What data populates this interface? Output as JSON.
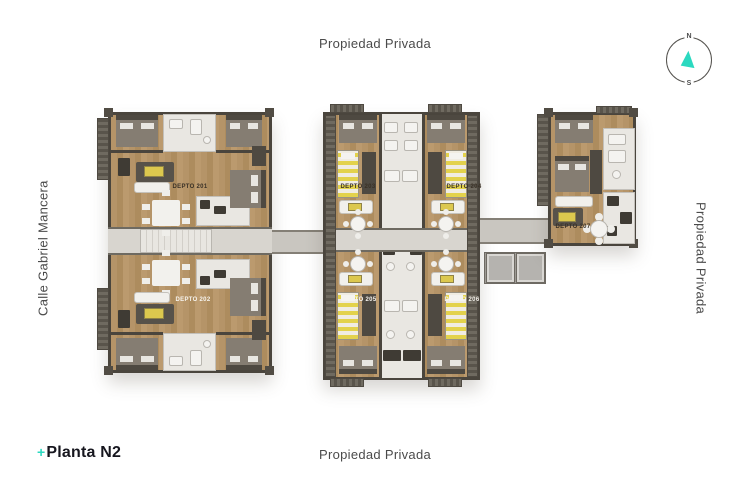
{
  "page": {
    "title_prefix": "+",
    "title": "Planta N2"
  },
  "boundaries": {
    "top": "Propiedad Privada",
    "bottom": "Propiedad Privada",
    "left": "Calle Gabriel Mancera",
    "right": "Propiedad Privada"
  },
  "compass": {
    "north": "N",
    "south": "S"
  },
  "colors": {
    "accent_teal": "#2BD9C0",
    "boundary_text": "#4B4B4B",
    "title_text": "#16161E",
    "wood_floor": "#B29260",
    "wall": "#4A453D",
    "marble": "#E9E7E2",
    "corridor": "#D8D5CF",
    "balcony": "#645F55",
    "furniture_yellow": "#DCC84E",
    "unit_label_dark": "#3A3126",
    "unit_label_light": "#F7F4EE"
  },
  "plan": {
    "units": [
      {
        "id": "depto-201",
        "label": "DEPTO 201",
        "label_style": "dark"
      },
      {
        "id": "depto-202",
        "label": "DEPTO 202",
        "label_style": "light"
      },
      {
        "id": "depto-203",
        "label": "DEPTO 203",
        "label_style": "dark"
      },
      {
        "id": "depto-204",
        "label": "DEPTO 204",
        "label_style": "dark"
      },
      {
        "id": "depto-205",
        "label": "DEPTO 205",
        "label_style": "light"
      },
      {
        "id": "depto-206",
        "label": "DEPTO 206",
        "label_style": "light"
      },
      {
        "id": "depto-207",
        "label": "DEPTO 207",
        "label_style": "dark"
      }
    ]
  }
}
